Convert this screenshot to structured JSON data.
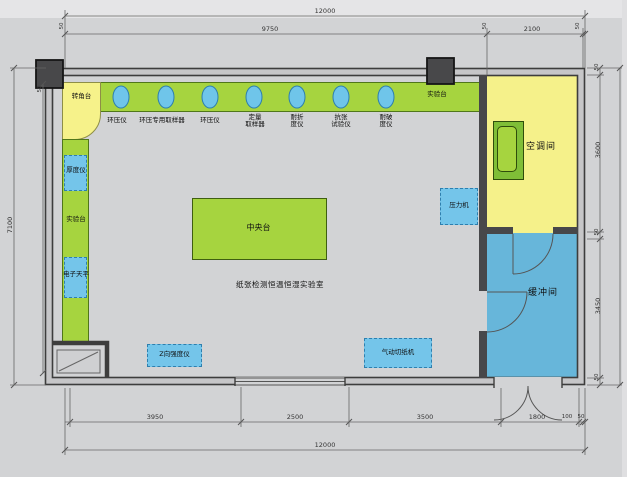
{
  "room": {
    "name": "纸张检测恒温恒湿实验室",
    "ac_room_label": "空调间",
    "buffer_room_label": "缓冲间"
  },
  "benches": {
    "corner_label": "转角台",
    "left_bench_label": "实验台",
    "top_bench_label": "实验台",
    "central_label": "中央台"
  },
  "instruments": {
    "top_row": [
      {
        "label": "环压仪"
      },
      {
        "label": "环压专用取样器"
      },
      {
        "label": "环压仪"
      },
      {
        "label": "定量\n取样器"
      },
      {
        "label": "耐折\n度仪"
      },
      {
        "label": "抗张\n试验仪"
      },
      {
        "label": "耐破\n度仪"
      }
    ],
    "thickness_gauge": "厚度仪",
    "balance": "电子天平",
    "press": "压力机",
    "z_tester": "Z向强度仪",
    "pneumatic_cutter": "气动切纸机"
  },
  "dimensions": {
    "top_total": "12000",
    "top_main": "9750",
    "top_right": "2100",
    "wall_tick": "50",
    "left_total": "7100",
    "right_ac": "3600",
    "right_buffer": "3450",
    "bottom_1": "3950",
    "bottom_2": "2500",
    "bottom_3": "3500",
    "bottom_4": "1800",
    "bottom_5": "100",
    "bottom_6": "50",
    "bottom_total": "12000"
  },
  "colors": {
    "bench_green": "#a6d43f",
    "room_yellow": "#f5f18a",
    "equipment_blue": "#74c5ea",
    "buffer_blue": "#67b6da",
    "wall_gray": "#3d3d3d"
  }
}
